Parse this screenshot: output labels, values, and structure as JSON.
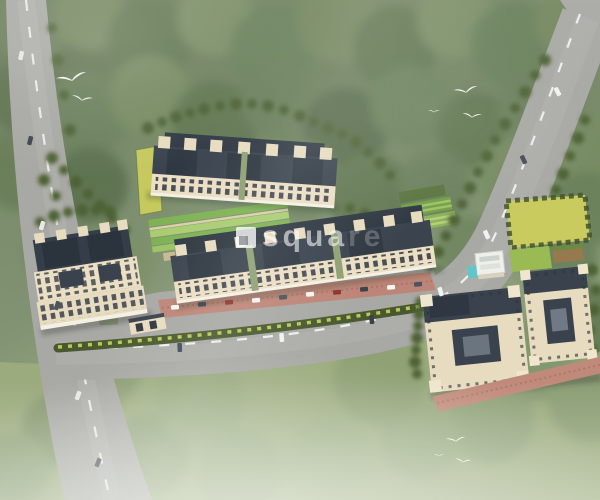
{
  "scene": {
    "title": "Aerial 3D master-plan render of a gated residential apartment complex in woodland",
    "watermark": {
      "text": "square",
      "strong_part": "squa",
      "faint_part": "re",
      "logo": "white-square-logo"
    },
    "palette": {
      "foliage_base": "#7e9070",
      "foliage_dark": "#5f7450",
      "grass_field": "#9cab7e",
      "road_asphalt": "#a8a8a4",
      "lane_marking": "#ffffff",
      "building_wall": "#ebdfc4",
      "building_roof": "#3a434e",
      "paving_red": "#bd8577",
      "lawn_yellow_green": "#c9cb5f",
      "garden_green": "#7eb253",
      "hedge_dark": "#48592f",
      "pool_cyan": "#5ec7c9",
      "bird_white": "#fbfdf8"
    },
    "counts": {
      "building_clusters": 4,
      "birds": 8,
      "roads": 2,
      "parked_cars_row": 10
    },
    "labels": {
      "left_road": "tree-lined road along west edge",
      "main_road": "curved arterial road entering from northeast",
      "top_cluster": "north row of apartment blocks",
      "middle_cluster": "central row of apartment blocks",
      "left_cluster": "west apartment blocks with entrance gate",
      "bottom_right_cluster": "twin courtyard blocks (southeast)",
      "amenity_area": "landscaped striped gardens with swimming pool",
      "grass_field": "open south lawn"
    }
  }
}
